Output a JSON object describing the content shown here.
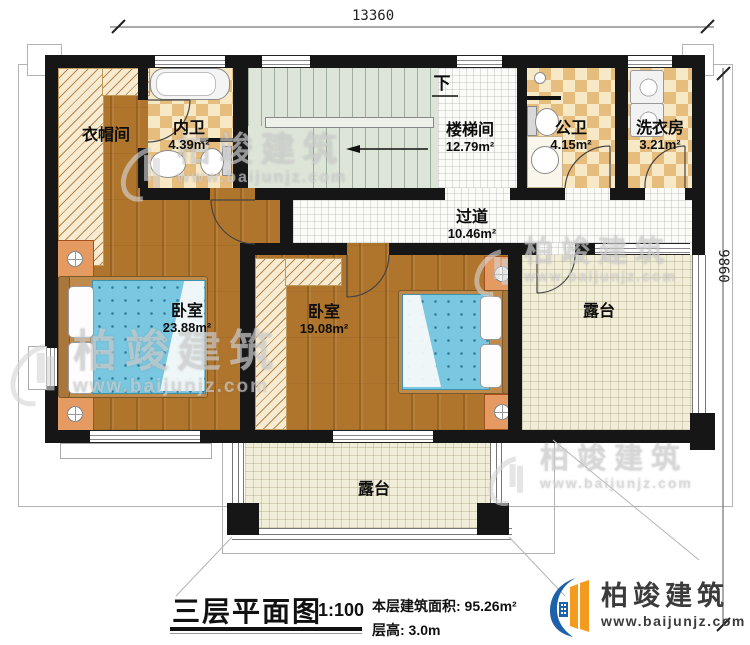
{
  "dimensions": {
    "width_mm": "13360",
    "depth_mm": "9860"
  },
  "rooms": {
    "cloakroom": {
      "label": "衣帽间",
      "area": ""
    },
    "inner_bath": {
      "label": "内卫",
      "area": "4.39m²"
    },
    "stairwell": {
      "label": "楼梯间",
      "area": "12.79m²"
    },
    "public_bath": {
      "label": "公卫",
      "area": "4.15m²"
    },
    "laundry": {
      "label": "洗衣房",
      "area": "3.21m²"
    },
    "corridor": {
      "label": "过道",
      "area": "10.46m²"
    },
    "bedroom_left": {
      "label": "卧室",
      "area": "23.88m²"
    },
    "bedroom_middle": {
      "label": "卧室",
      "area": "19.08m²"
    },
    "terrace_right": {
      "label": "露台"
    },
    "terrace_bottom": {
      "label": "露台"
    },
    "stairs_down_label": "下"
  },
  "title_block": {
    "plan_title": "三层平面图",
    "scale": "1:100",
    "floor_area": "本层建筑面积: 95.26m²",
    "floor_height": "层高: 3.0m"
  },
  "branding": {
    "company": "柏竣建筑",
    "website": "www.baijunjz.com"
  },
  "watermark": {
    "company": "柏竣建筑",
    "website": "www.baijunjz.com"
  },
  "colors": {
    "wall": "#161616",
    "wood_floor": "#b0752c",
    "bath_tile": "#e7bd7e",
    "terrace": "#f0edd9",
    "stairs": "#dde5d8",
    "bed_quilt": "#79c7e0",
    "brand_blue": "#1e61ab",
    "brand_orange": "#f49a1f"
  }
}
